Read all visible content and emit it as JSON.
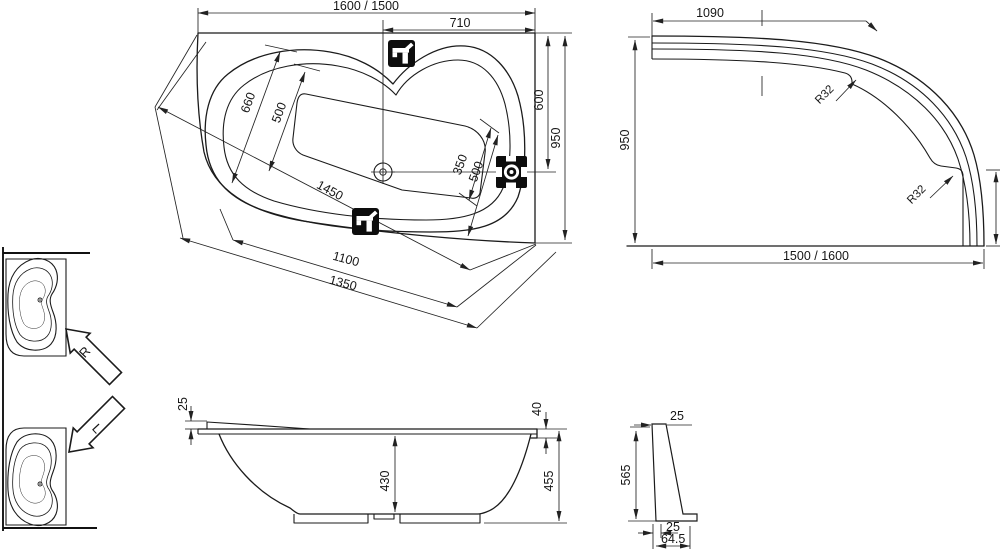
{
  "colors": {
    "background": "#ffffff",
    "ink": "#1b1b1b"
  },
  "plan_view": {
    "dims": {
      "overall_length": "1600 / 1500",
      "tap_offset": "710",
      "foot_width_outer": "660",
      "foot_width_inner": "500",
      "head_end_width": "600",
      "overall_width": "950",
      "seat_width": "350",
      "seat_depth": "500",
      "diagonal_length": "1450",
      "bottom_length_inner": "1100",
      "bottom_length_outer": "1350"
    }
  },
  "apron_view": {
    "dims": {
      "straight_section": "1090",
      "width": "950",
      "radius_upper": "R32",
      "radius_lower": "R32",
      "length": "1500 / 1600"
    }
  },
  "elevation_view": {
    "dims": {
      "rim_rise": "25",
      "rim_lip": "40",
      "inner_depth": "430",
      "total_height": "455"
    }
  },
  "apron_section_view": {
    "dims": {
      "top_thickness": "25",
      "height": "565",
      "foot_step": "25",
      "base_depth": "64.5"
    }
  },
  "variants": {
    "right_label": "R",
    "left_label": "L"
  },
  "icons": {
    "tap_top": "faucet-icon",
    "tap_side": "faucet-icon",
    "water_inlet": "water-inlet-icon",
    "drain": "drain-icon",
    "variant_right_arrow": "arrow-up-left-icon",
    "variant_left_arrow": "arrow-down-left-icon"
  }
}
